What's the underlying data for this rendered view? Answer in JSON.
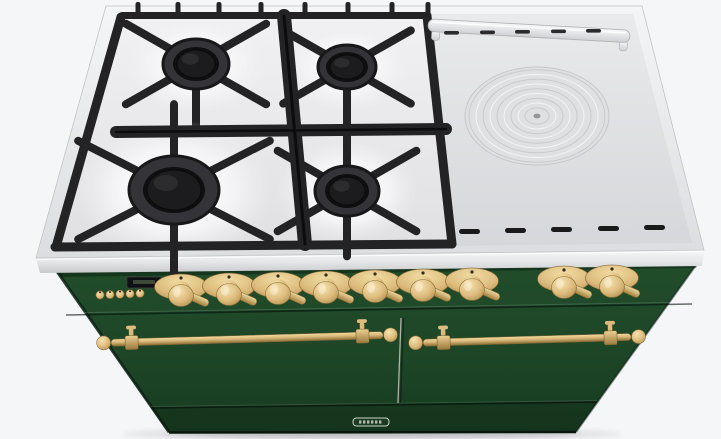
{
  "scene": {
    "subject": "range-cooker-3d-render",
    "view": "front-top-perspective",
    "style": "green body with brass hardware, gas hob left, simmer plate right"
  },
  "colors": {
    "background": "#f5f6f8",
    "green": "#1e4728",
    "green_dark": "#16381f",
    "green_deep": "#0b2113",
    "rim_light": "#f3f4f6",
    "rim": "#e3e4e7",
    "rim_dark": "#c3c4c8",
    "enamel": "#eeeef0",
    "plate": "#e3e4e6",
    "grate": "#232326",
    "grate_deep": "#101012",
    "brass_light": "#f2dda3",
    "brass": "#dcbb7d",
    "brass_dark": "#aa8748",
    "brass_deep": "#705a29",
    "divider": "#b6b8b2",
    "display_bg": "#0e1014",
    "display_glow": "#49523f",
    "badge_line": "#ccd3c6"
  },
  "cooktop": {
    "gas_burner_count": 4,
    "gas_burners": [
      {
        "cx": 196,
        "cy": 64,
        "rx": 33,
        "ry": 25,
        "cap_rx": 19,
        "cap_ry": 14,
        "len": 56,
        "spokes": [
          38,
          142,
          218,
          322,
          90
        ]
      },
      {
        "cx": 347,
        "cy": 67,
        "rx": 29,
        "ry": 22,
        "cap_rx": 17,
        "cap_ry": 12,
        "len": 52,
        "spokes": [
          38,
          142,
          218,
          322,
          90
        ]
      },
      {
        "cx": 174,
        "cy": 190,
        "rx": 45,
        "ry": 34,
        "cap_rx": 27,
        "cap_ry": 20,
        "len": 72,
        "spokes": [
          35,
          145,
          215,
          325,
          90,
          270
        ]
      },
      {
        "cx": 347,
        "cy": 191,
        "rx": 32,
        "ry": 25,
        "cap_rx": 18,
        "cap_ry": 14,
        "len": 56,
        "spokes": [
          38,
          142,
          218,
          322,
          90,
          270
        ]
      }
    ],
    "back_tabs": [
      138,
      178,
      219,
      261,
      305,
      348,
      392,
      428
    ],
    "griddle": {
      "ring_center": {
        "cx": 537,
        "cy": 116
      },
      "ring_radii": [
        68,
        61,
        54,
        47,
        40,
        33,
        26,
        19,
        12
      ],
      "top_slots": [
        {
          "x": 444,
          "y": 31
        },
        {
          "x": 480,
          "y": 30.5
        },
        {
          "x": 515,
          "y": 30
        },
        {
          "x": 551,
          "y": 29.5
        },
        {
          "x": 586,
          "y": 29
        }
      ],
      "bottom_slots": [
        {
          "x": 459,
          "y": 229
        },
        {
          "x": 505,
          "y": 228
        },
        {
          "x": 551,
          "y": 227
        },
        {
          "x": 598,
          "y": 226
        },
        {
          "x": 644,
          "y": 225
        }
      ]
    }
  },
  "control_panel": {
    "knob_count": 9,
    "knobs": [
      {
        "x": 181,
        "y": 287
      },
      {
        "x": 229,
        "y": 286
      },
      {
        "x": 278,
        "y": 285
      },
      {
        "x": 326,
        "y": 284
      },
      {
        "x": 375,
        "y": 283
      },
      {
        "x": 423,
        "y": 282
      },
      {
        "x": 472,
        "y": 281
      },
      {
        "x": 564,
        "y": 279
      },
      {
        "x": 612,
        "y": 278
      }
    ],
    "timer_buttons": [
      {
        "x": 100,
        "y": 295
      },
      {
        "x": 110,
        "y": 294.6
      },
      {
        "x": 120,
        "y": 294.2
      },
      {
        "x": 130,
        "y": 293.8
      },
      {
        "x": 140,
        "y": 293.4
      }
    ],
    "display": {
      "x": 127,
      "y": 277,
      "w": 35,
      "h": 11
    }
  },
  "front": {
    "door_count": 2,
    "rails": [
      {
        "x": 99,
        "y": 338,
        "len": 296,
        "angle": -1.6
      },
      {
        "x": 411,
        "y": 338,
        "len": 232,
        "angle": -1.6
      }
    ],
    "badge": {
      "cx": 371,
      "cy": 422,
      "w": 36,
      "h": 8
    }
  }
}
